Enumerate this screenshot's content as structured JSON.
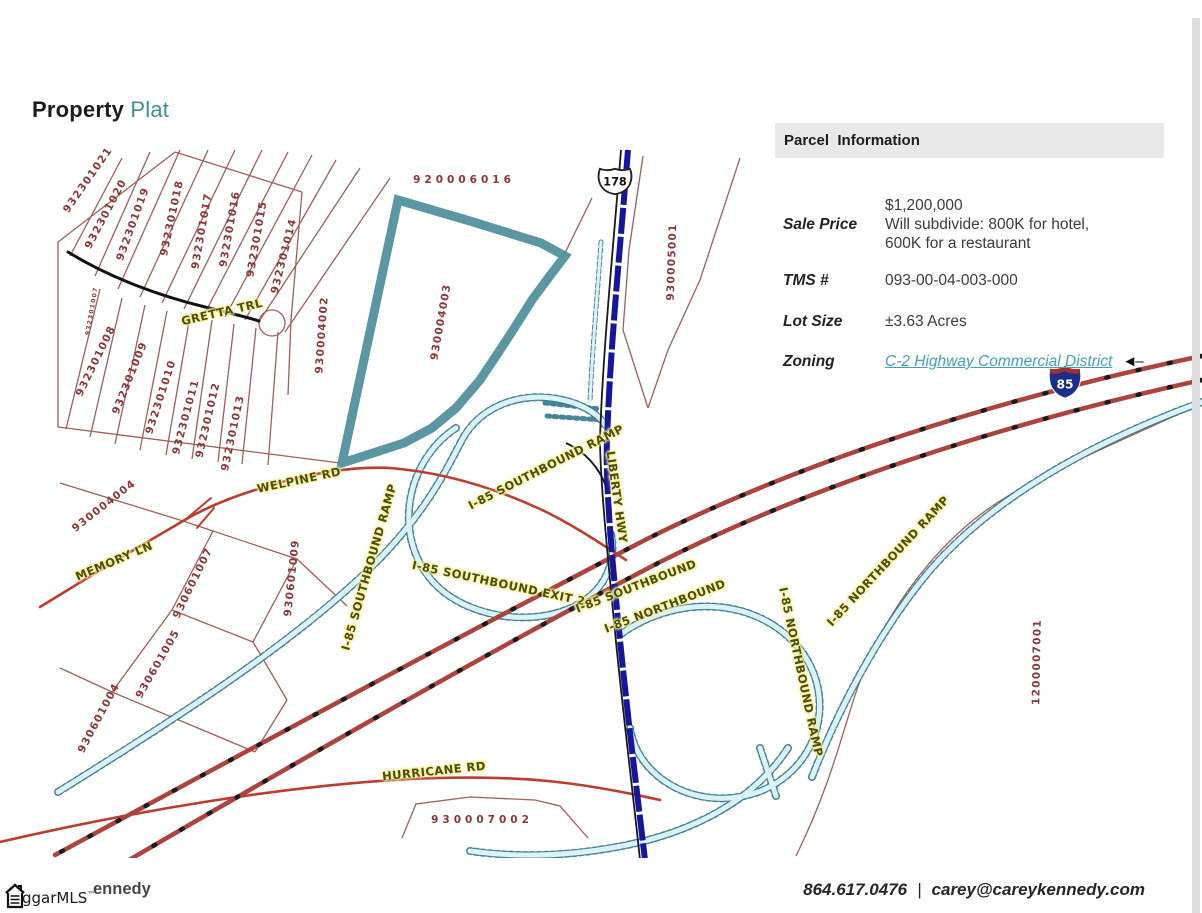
{
  "title": {
    "primary": "Property",
    "secondary": "Plat"
  },
  "panel": {
    "header": "Parcel  Information",
    "rows": [
      {
        "label": "Sale Price",
        "value_lines": [
          "$1,200,000",
          "Will subdivide: 800K for hotel,",
          "600K for a restaurant"
        ]
      },
      {
        "label": "TMS #",
        "value_lines": [
          "093-00-04-003-000"
        ]
      },
      {
        "label": "Lot Size",
        "value_lines": [
          "±3.63 Acres"
        ]
      },
      {
        "label": "Zoning",
        "value_lines": [
          "C-2 Highway Commercial District"
        ],
        "arrow": "◄–"
      }
    ]
  },
  "map": {
    "highlight_color": "#4e8f9c",
    "shields": [
      {
        "kind": "us-route",
        "text": "178"
      },
      {
        "kind": "interstate",
        "text": "85"
      }
    ],
    "parcel_labels": [
      {
        "t": "932301021",
        "x": 88,
        "y": 180,
        "r": -55
      },
      {
        "t": "932301020",
        "x": 106,
        "y": 214,
        "r": -62
      },
      {
        "t": "932301019",
        "x": 133,
        "y": 224,
        "r": -70
      },
      {
        "t": "932301018",
        "x": 172,
        "y": 218,
        "r": -78
      },
      {
        "t": "932301017",
        "x": 202,
        "y": 231,
        "r": -80
      },
      {
        "t": "932301016",
        "x": 230,
        "y": 229,
        "r": -80
      },
      {
        "t": "932301015",
        "x": 257,
        "y": 239,
        "r": -80
      },
      {
        "t": "932301014",
        "x": 284,
        "y": 256,
        "r": -76
      },
      {
        "t": "932301007",
        "x": 92,
        "y": 311,
        "r": -80,
        "s": 6
      },
      {
        "t": "932301008",
        "x": 96,
        "y": 361,
        "r": -64
      },
      {
        "t": "932301009",
        "x": 130,
        "y": 378,
        "r": -68
      },
      {
        "t": "932301010",
        "x": 161,
        "y": 397,
        "r": -72
      },
      {
        "t": "932301011",
        "x": 186,
        "y": 417,
        "r": -75
      },
      {
        "t": "932301012",
        "x": 208,
        "y": 420,
        "r": -77
      },
      {
        "t": "932301013",
        "x": 233,
        "y": 433,
        "r": -78
      },
      {
        "t": "930004004",
        "x": 104,
        "y": 506,
        "r": -38
      },
      {
        "t": "930601007",
        "x": 193,
        "y": 583,
        "r": -64
      },
      {
        "t": "930601009",
        "x": 292,
        "y": 578,
        "r": -84
      },
      {
        "t": "930601005",
        "x": 158,
        "y": 664,
        "r": -60
      },
      {
        "t": "930601004",
        "x": 99,
        "y": 718,
        "r": -62
      },
      {
        "t": "920006016",
        "x": 464,
        "y": 180,
        "r": 0,
        "ls": 4
      },
      {
        "t": "930004002",
        "x": 322,
        "y": 335,
        "r": -86
      },
      {
        "t": "930004003",
        "x": 441,
        "y": 322,
        "r": -80
      },
      {
        "t": "930005001",
        "x": 672,
        "y": 262,
        "r": -88
      },
      {
        "t": "1200007001",
        "x": 1037,
        "y": 662,
        "r": -89
      },
      {
        "t": "930007002",
        "x": 482,
        "y": 820,
        "r": 0,
        "ls": 4
      }
    ],
    "road_labels": [
      {
        "t": "GRETTA TRL",
        "x": 222,
        "y": 312,
        "r": -13
      },
      {
        "t": "WELPINE RD",
        "x": 299,
        "y": 480,
        "r": -12
      },
      {
        "t": "MEMORY LN",
        "x": 114,
        "y": 561,
        "r": -23
      },
      {
        "t": "HURRICANE RD",
        "x": 434,
        "y": 771,
        "r": -6
      },
      {
        "t": "I-85 SOUTHBOUND RAMP",
        "x": 369,
        "y": 567,
        "r": -74
      },
      {
        "t": "I-85 SOUTHBOUND RAMP",
        "x": 546,
        "y": 467,
        "r": -27
      },
      {
        "t": "I-85 SOUTHBOUND EXIT 21",
        "x": 503,
        "y": 584,
        "r": 12
      },
      {
        "t": "LIBERTY HWY",
        "x": 617,
        "y": 497,
        "r": 82
      },
      {
        "t": "I-85 SOUTHBOUND",
        "x": 636,
        "y": 586,
        "r": -21
      },
      {
        "t": "I-85 NORTHBOUND",
        "x": 665,
        "y": 606,
        "r": -21
      },
      {
        "t": "I-85 NORTHBOUND RAMP",
        "x": 888,
        "y": 561,
        "r": -47
      },
      {
        "t": "I-85 NORTHBOUND RAMP",
        "x": 801,
        "y": 672,
        "r": 78
      }
    ]
  },
  "footer": {
    "logo_text": "ggarMLS",
    "logo_tm": "™",
    "partial_name": "ennedy",
    "phone": "864.617.0476",
    "separator": "|",
    "email": "carey@careykennedy.com"
  }
}
